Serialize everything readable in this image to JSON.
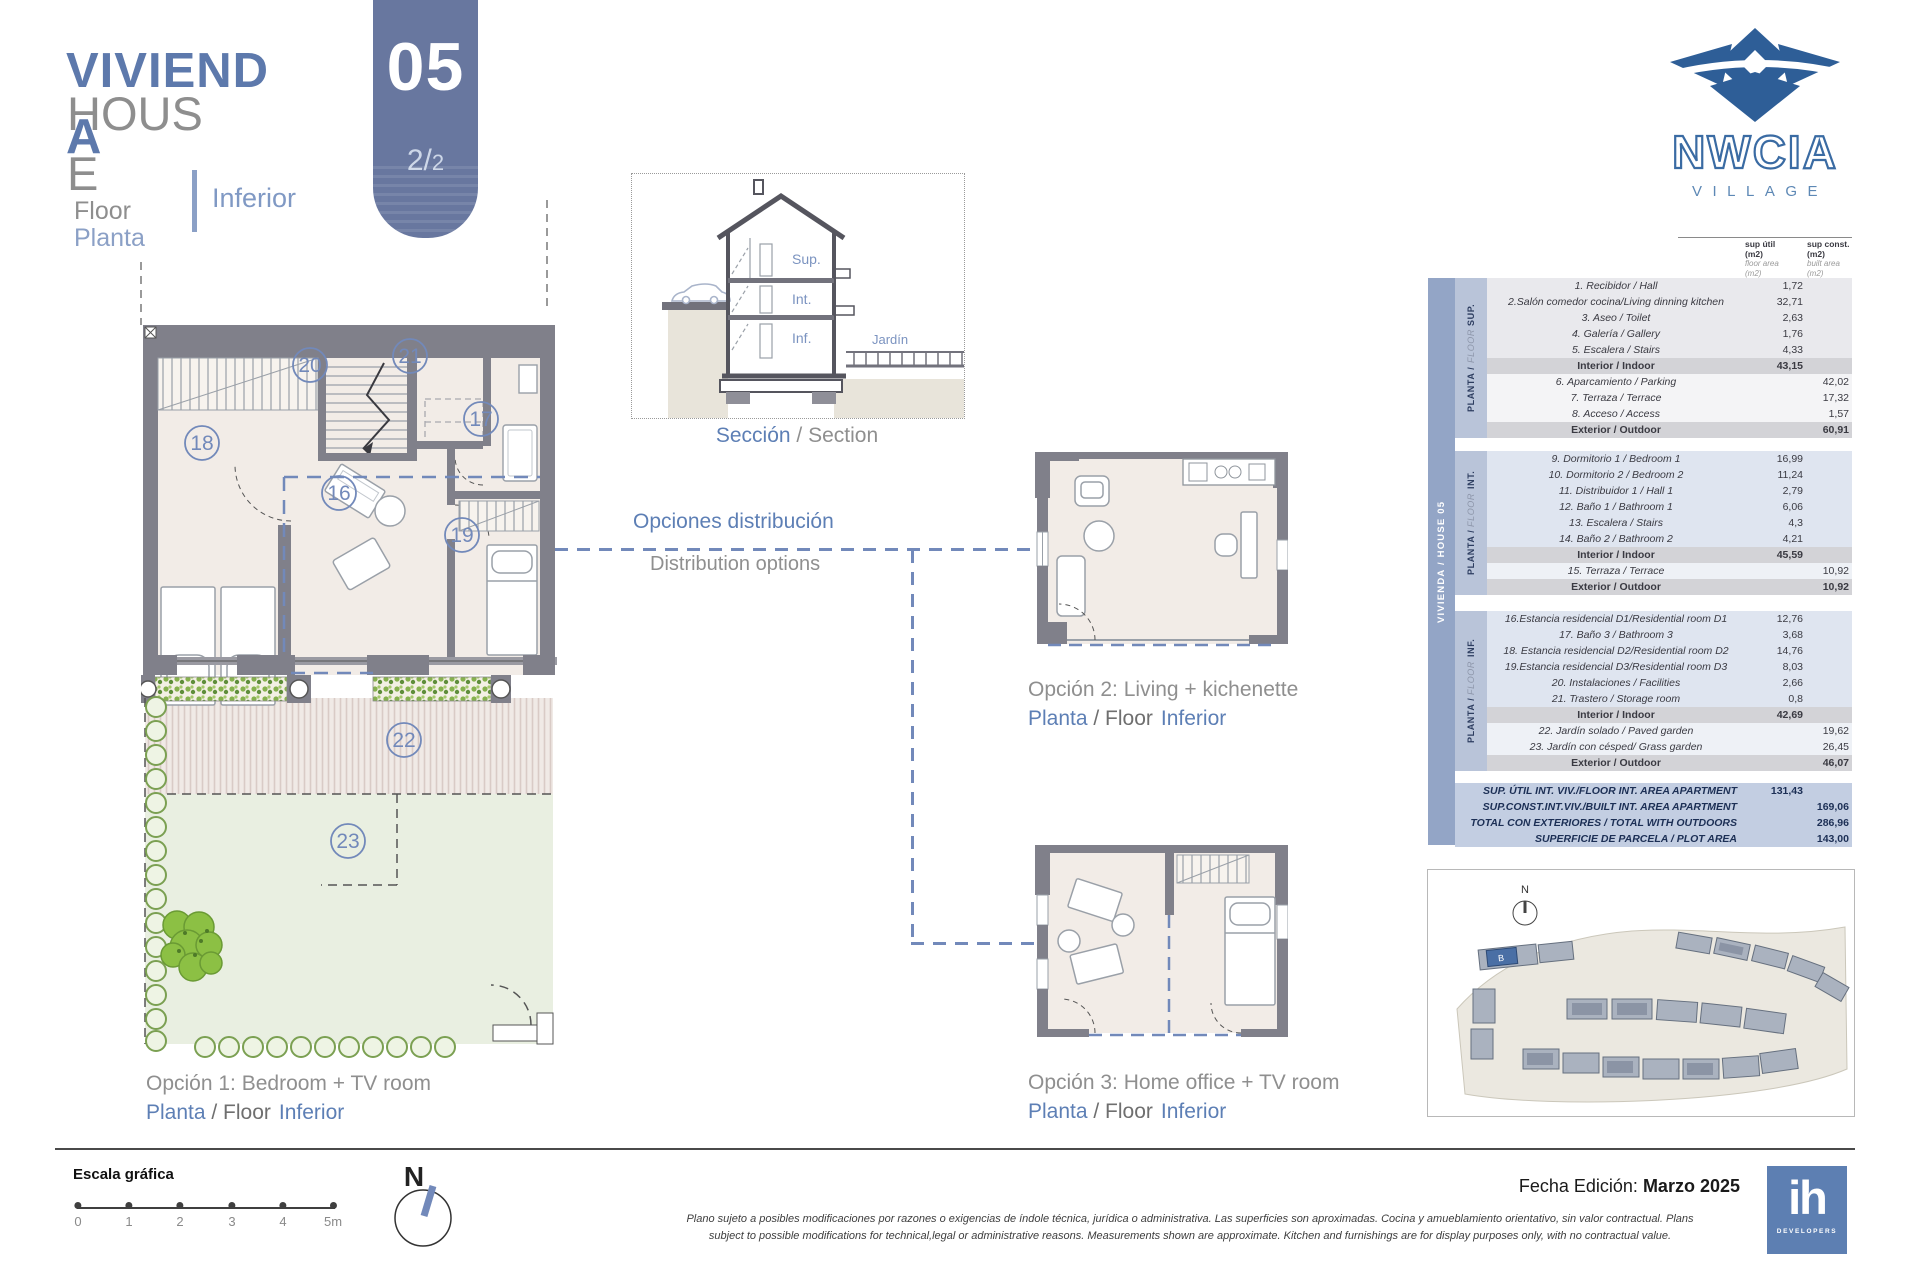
{
  "header": {
    "title_es": "VIVIENDA",
    "title_en": "HOUSE",
    "floor_en": "Floor",
    "floor_es": "Planta",
    "floor_value": "Inferior",
    "badge_number": "05",
    "badge_page_big": "2/",
    "badge_page_small": "2"
  },
  "brand": {
    "name": "NWCIA",
    "tagline": "VILLAGE"
  },
  "section_view": {
    "caption_es": "Sección",
    "caption_sep": " / ",
    "caption_en": "Section",
    "level_sup": "Sup.",
    "level_int": "Int.",
    "level_inf": "Inf.",
    "garden": "Jardín"
  },
  "distribution": {
    "label_es": "Opciones distribución",
    "label_en": "Distribution options"
  },
  "plan_rooms": {
    "r16": "16",
    "r17": "17",
    "r18": "18",
    "r19": "19",
    "r20": "20",
    "r21": "21",
    "r22": "22",
    "r23": "23"
  },
  "options": [
    {
      "title": "Opción 1: Bedroom + TV room",
      "floor_es": "Planta",
      "floor_mid": " / Floor",
      "floor_value": "Inferior"
    },
    {
      "title": "Opción 2: Living + kichenette",
      "floor_es": "Planta",
      "floor_mid": " / Floor",
      "floor_value": "Inferior"
    },
    {
      "title": "Opción 3: Home office + TV room",
      "floor_es": "Planta",
      "floor_mid": " / Floor",
      "floor_value": "Inferior"
    }
  ],
  "area_table": {
    "side_label": "VIVIENDA / HOUSE 05",
    "col_util": {
      "l1": "sup útil",
      "l2": "(m2)",
      "l3": "floor area",
      "l4": "(m2)"
    },
    "col_const": {
      "l1": "sup const.",
      "l2": "(m2)",
      "l3": "built area",
      "l4": "(m2)"
    },
    "sections": [
      {
        "band_bold": "PLANTA / ",
        "band_light": "FLOOR ",
        "band_tag": "SUP.",
        "rows": [
          {
            "label": "1. Recibidor / Hall",
            "util": "1,72",
            "const": "",
            "style": "int"
          },
          {
            "label": "2.Salón comedor cocina/Living dinning kitchen",
            "util": "32,71",
            "const": "",
            "style": "int"
          },
          {
            "label": "3. Aseo / Toilet",
            "util": "2,63",
            "const": "",
            "style": "int"
          },
          {
            "label": "4. Galería / Gallery",
            "util": "1,76",
            "const": "",
            "style": "int"
          },
          {
            "label": "5. Escalera / Stairs",
            "util": "4,33",
            "const": "",
            "style": "int"
          },
          {
            "label": "Interior / Indoor",
            "util": "43,15",
            "const": "",
            "style": "subtotal"
          },
          {
            "label": "6. Aparcamiento / Parking",
            "util": "",
            "const": "42,02",
            "style": "ext"
          },
          {
            "label": "7. Terraza / Terrace",
            "util": "",
            "const": "17,32",
            "style": "ext"
          },
          {
            "label": "8. Acceso / Access",
            "util": "",
            "const": "1,57",
            "style": "ext"
          },
          {
            "label": "Exterior / Outdoor",
            "util": "",
            "const": "60,91",
            "style": "subtotal"
          }
        ]
      },
      {
        "band_bold": "PLANTA / ",
        "band_light": "FLOOR ",
        "band_tag": "INT.",
        "rows": [
          {
            "label": "9.  Dormitorio 1 / Bedroom 1",
            "util": "16,99",
            "const": "",
            "style": "int"
          },
          {
            "label": "10.  Dormitorio 2 / Bedroom 2",
            "util": "11,24",
            "const": "",
            "style": "int"
          },
          {
            "label": "11. Distribuidor 1 / Hall 1",
            "util": "2,79",
            "const": "",
            "style": "int"
          },
          {
            "label": "12.  Baño 1 / Bathroom 1",
            "util": "6,06",
            "const": "",
            "style": "int"
          },
          {
            "label": "13. Escalera / Stairs",
            "util": "4,3",
            "const": "",
            "style": "int"
          },
          {
            "label": "14. Baño 2 / Bathroom 2",
            "util": "4,21",
            "const": "",
            "style": "int"
          },
          {
            "label": "Interior / Indoor",
            "util": "45,59",
            "const": "",
            "style": "subtotal"
          },
          {
            "label": "15. Terraza / Terrace",
            "util": "",
            "const": "10,92",
            "style": "ext"
          },
          {
            "label": "Exterior / Outdoor",
            "util": "",
            "const": "10,92",
            "style": "subtotal"
          }
        ]
      },
      {
        "band_bold": "PLANTA / ",
        "band_light": "FLOOR ",
        "band_tag": "INF.",
        "rows": [
          {
            "label": "16.Estancia residencial D1/Residential  room D1",
            "util": "12,76",
            "const": "",
            "style": "int"
          },
          {
            "label": "17. Baño 3 / Bathroom 3",
            "util": "3,68",
            "const": "",
            "style": "int"
          },
          {
            "label": "18. Estancia residencial D2/Residential room D2",
            "util": "14,76",
            "const": "",
            "style": "int"
          },
          {
            "label": "19.Estancia residencial D3/Residential  room D3",
            "util": "8,03",
            "const": "",
            "style": "int"
          },
          {
            "label": "20. Instalaciones / Facilities",
            "util": "2,66",
            "const": "",
            "style": "int"
          },
          {
            "label": "21. Trastero / Storage room",
            "util": "0,8",
            "const": "",
            "style": "int"
          },
          {
            "label": "Interior / Indoor",
            "util": "42,69",
            "const": "",
            "style": "subtotal"
          },
          {
            "label": "22. Jardín solado / Paved garden",
            "util": "",
            "const": "19,62",
            "style": "ext"
          },
          {
            "label": "23. Jardín con césped/ Grass garden",
            "util": "",
            "const": "26,45",
            "style": "ext"
          },
          {
            "label": "Exterior / Outdoor",
            "util": "",
            "const": "46,07",
            "style": "subtotal"
          }
        ]
      }
    ],
    "summary": [
      {
        "label": "SUP. ÚTIL INT. VIV./FLOOR INT. AREA APARTMENT",
        "util": "131,43",
        "const": ""
      },
      {
        "label": "SUP.CONST.INT.VIV./BUILT INT. AREA APARTMENT",
        "util": "",
        "const": "169,06"
      },
      {
        "label": "TOTAL CON EXTERIORES / TOTAL WITH OUTDOORS",
        "util": "",
        "const": "286,96"
      },
      {
        "label": "SUPERFICIE DE PARCELA / PLOT AREA",
        "util": "",
        "const": "143,00"
      }
    ]
  },
  "site_plan": {
    "north": "N",
    "highlight": "B"
  },
  "footer": {
    "scale_title": "Escala gráfica",
    "scale_ticks": [
      "0",
      "1",
      "2",
      "3",
      "4",
      "5m"
    ],
    "north": "N",
    "disclaimer_line1": "Plano sujeto a posibles modificaciones por razones o exigencias de índole técnica, jurídica o administrativa. Las superficies son aproximadas. Cocina y amueblamiento orientativo, sin valor contractual.    Plans",
    "disclaimer_line2": "subject to possible modifications for technical,legal or administrative reasons. Measurements shown are approximate. Kitchen and furnishings are for display purposes only, with no contractual value.",
    "edition_label": "Fecha Edición: ",
    "edition_value": "Marzo 2025",
    "dev_logo_text": "ih",
    "dev_logo_sub": "DEVELOPERS"
  }
}
